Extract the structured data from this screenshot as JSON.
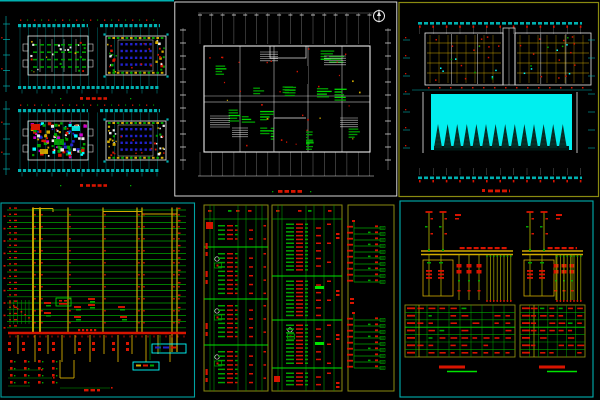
{
  "image": {
    "width": 600,
    "height": 400,
    "background": "#000000",
    "description": "Montage of six black-background CAD sheets: paired floor-plan strips, an overall floor plan, a site plan with pool and tree row, an electrical riser diagram, distribution panel schedules, and two transformer single-line diagrams with tables"
  },
  "palette": {
    "cyan": "#00b0b0",
    "bright_cyan": "#00ffff",
    "pool_cyan": "#00efef",
    "white": "#ececec",
    "green": "#00a400",
    "bright_green": "#00e400",
    "red": "#d81400",
    "yellow": "#d2aa00",
    "olive": "#8a8a10",
    "olive_line": "#a8a800",
    "blue": "#2222cc",
    "magenta": "#cc00cc",
    "tree_fill": "#052a22",
    "tree_stripe": "#0c4438",
    "teal_frame": "#00a2a2"
  },
  "panels": [
    {
      "id": "floor-plan-strips",
      "name": "paired floor plan strips sheet",
      "x": 0,
      "y": 0,
      "w": 174,
      "h": 200,
      "seed": 7,
      "strips": [
        {
          "band_y": 24,
          "bld_y": 36,
          "band2_y": 86,
          "title_y": 97,
          "left_unit": "light",
          "right_unit": "blue-grid"
        },
        {
          "band_y": 109,
          "bld_y": 121,
          "band2_y": 169,
          "title_y": 184,
          "left_unit": "dense",
          "right_unit": "blue-grid"
        }
      ]
    },
    {
      "id": "overall-floor-plan",
      "name": "overall floor plan sheet with compass",
      "x": 174,
      "y": 0,
      "w": 224,
      "h": 199,
      "seed": 11,
      "grid_cols": 16,
      "title_y": 190
    },
    {
      "id": "site-plan",
      "name": "site plan sheet with pool and tree row",
      "x": 398,
      "y": 0,
      "w": 202,
      "h": 199,
      "seed": 23,
      "tree_count": 14,
      "pool": {
        "x": 33,
        "y": 94,
        "w": 141,
        "h": 56
      }
    },
    {
      "id": "riser-diagram",
      "name": "electrical riser diagram sheet",
      "x": 0,
      "y": 202,
      "w": 196,
      "h": 197,
      "seed": 31,
      "floor_lines": 20,
      "risers": [
        [
          33,
          131
        ],
        [
          40,
          131
        ],
        [
          68,
          131
        ],
        [
          103,
          131
        ],
        [
          137,
          131
        ],
        [
          142,
          131
        ],
        [
          172,
          150
        ],
        [
          177,
          150
        ]
      ],
      "bus_y": 131,
      "title_y": 187
    },
    {
      "id": "panel-schedules",
      "name": "distribution panel schedule tables sheet",
      "x": 202,
      "y": 200,
      "w": 196,
      "h": 198,
      "seed": 41,
      "boxes": [
        {
          "x": 2,
          "y": 5,
          "w": 64,
          "h": 186,
          "seps": [
            47,
            99,
            145
          ],
          "cols": [
            8,
            12,
            36,
            44,
            54,
            60
          ]
        },
        {
          "x": 70,
          "y": 5,
          "w": 70,
          "h": 186,
          "seps": [
            76,
            120,
            168
          ],
          "cols": [
            76,
            80,
            104,
            112,
            122,
            132
          ]
        },
        {
          "x": 146,
          "y": 5,
          "w": 46,
          "h": 186,
          "clusters": [
            {
              "top": 26,
              "rows": 10
            },
            {
              "top": 118,
              "rows": 9
            }
          ]
        }
      ]
    },
    {
      "id": "single-line-diagrams",
      "name": "transformer single line diagrams sheet",
      "x": 399,
      "y": 200,
      "w": 201,
      "h": 200,
      "seed": 53,
      "diagrams": [
        {
          "x": 22,
          "w": 92
        },
        {
          "x": 123,
          "w": 61
        }
      ],
      "tables": [
        {
          "x": 6,
          "y": 105,
          "w": 110,
          "h": 52
        },
        {
          "x": 121,
          "y": 105,
          "w": 65,
          "h": 52
        }
      ],
      "titles": [
        {
          "x": 40,
          "y": 167
        },
        {
          "x": 140,
          "y": 167
        }
      ]
    }
  ]
}
